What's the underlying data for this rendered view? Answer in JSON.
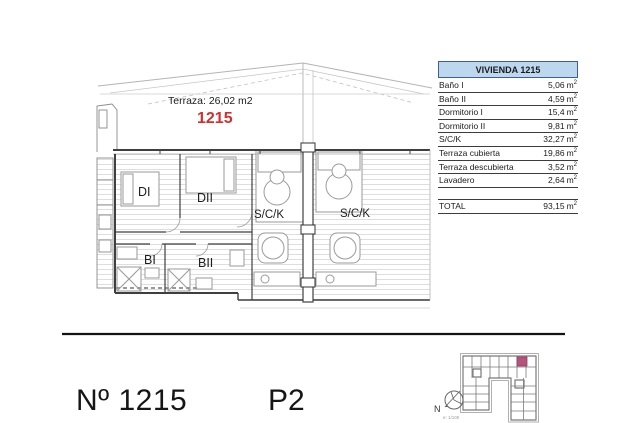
{
  "page": {
    "background": "#ffffff"
  },
  "plan": {
    "terrace_label": "Terraza: 26,02 m2",
    "unit_number": "1215",
    "unit_number_color": "#d22f2f",
    "room_labels": {
      "dormitorio_i": "DI",
      "dormitorio_ii": "DII",
      "bano_i": "BI",
      "bano_ii": "BII",
      "sck_left": "S/C/K",
      "sck_right": "S/C/K"
    }
  },
  "table": {
    "title": "VIVIENDA 1215",
    "title_bg": "#bdd7ee",
    "unit": "m",
    "unit_sup": "2",
    "rows": [
      {
        "label": "Baño I",
        "value": "5,06"
      },
      {
        "label": "Baño II",
        "value": "4,59"
      },
      {
        "label": "Dormitorio I",
        "value": "15,4"
      },
      {
        "label": "Dormitorio II",
        "value": "9,81"
      },
      {
        "label": "S/C/K",
        "value": "32,27"
      },
      {
        "label": "Terraza cubierta",
        "value": "19,86"
      },
      {
        "label": "Terraza descubierta",
        "value": "3,52"
      },
      {
        "label": "Lavadero",
        "value": "2,64"
      }
    ],
    "total": {
      "label": "TOTAL",
      "value": "93,15"
    }
  },
  "footer": {
    "unit_label": "Nº 1215",
    "floor_label": "P2"
  },
  "keyplan": {
    "north_label": "N",
    "scale_label": "e: 1/100",
    "highlight_color": "#b5537c"
  }
}
